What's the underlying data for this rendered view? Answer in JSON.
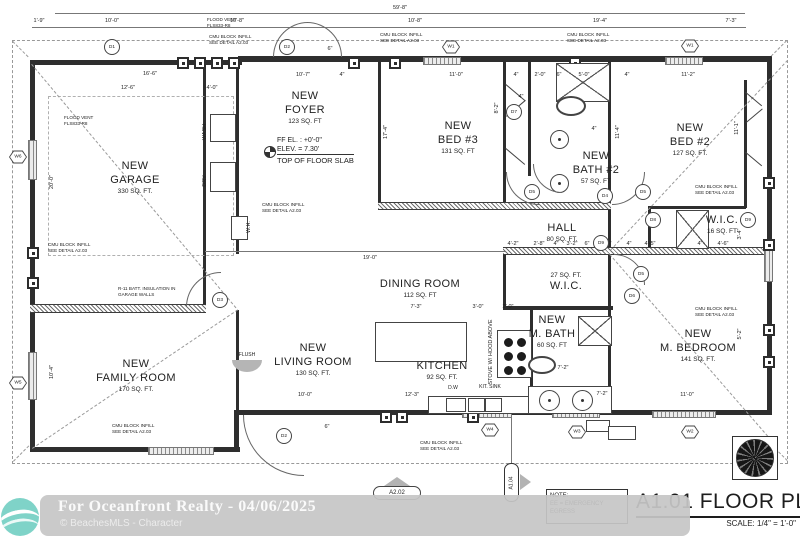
{
  "colors": {
    "wall": "#2e2e2e",
    "line": "#555555",
    "dashed": "#999999",
    "teal_logo": "#7fd3c8",
    "watermark_bg": "#c6c6c6",
    "marker_gray": "#b3b3b3"
  },
  "title_block": {
    "title": "A1.01 FLOOR PLAN",
    "scale": "SCALE: 1/4\" = 1'-0\""
  },
  "note_box": {
    "l1": "NOTE:",
    "l2": "EE = EMERGENCY",
    "l3": "EGRESS"
  },
  "watermark": {
    "line1": "For Oceanfront Realty - 04/06/2025",
    "line2": "© BeachesMLS - Character"
  },
  "markers": {
    "a202": "A2.02",
    "a104": "A1.04"
  },
  "ff_note": {
    "l1": "FF EL. : +0'-0\"",
    "l2": "ELEV. = 7.30'",
    "l3": "TOP OF FLOOR SLAB"
  },
  "rooms": [
    {
      "lines": [
        "NEW",
        "GARAGE"
      ],
      "sqft": "330 SQ. FT.",
      "x": 135,
      "y": 160
    },
    {
      "lines": [
        "NEW",
        "FOYER"
      ],
      "sqft": "123 SQ. FT",
      "x": 305,
      "y": 90
    },
    {
      "lines": [
        "NEW",
        "BED #3"
      ],
      "sqft": "131 SQ. FT",
      "x": 458,
      "y": 120
    },
    {
      "lines": [
        "NEW",
        "BATH #2"
      ],
      "sqft": "57 SQ. FT",
      "x": 596,
      "y": 150
    },
    {
      "lines": [
        "NEW",
        "BED #2"
      ],
      "sqft": "127 SQ. FT.",
      "x": 690,
      "y": 122
    },
    {
      "lines": [
        "HALL"
      ],
      "sqft": "80 SQ. FT.",
      "x": 562,
      "y": 222
    },
    {
      "lines": [
        "W.I.C."
      ],
      "sqft": "16 SQ. FT",
      "x": 722,
      "y": 214
    },
    {
      "lines": [
        "27 SQ. FT.",
        "W.I.C."
      ],
      "sqft": "",
      "x": 566,
      "y": 272
    },
    {
      "lines": [
        "DINING ROOM"
      ],
      "sqft": "112 SQ. FT",
      "x": 420,
      "y": 278
    },
    {
      "lines": [
        "NEW",
        "FAMILY ROOM"
      ],
      "sqft": "170 SQ. FT.",
      "x": 136,
      "y": 358
    },
    {
      "lines": [
        "NEW",
        "LIVING ROOM"
      ],
      "sqft": "130 SQ. FT.",
      "x": 313,
      "y": 342
    },
    {
      "lines": [
        "KITCHEN"
      ],
      "sqft": "92 SQ. FT.",
      "x": 442,
      "y": 360
    },
    {
      "lines": [
        "NEW",
        "M. BATH"
      ],
      "sqft": "60 SQ. FT",
      "x": 552,
      "y": 314
    },
    {
      "lines": [
        "NEW",
        "M. BEDROOM"
      ],
      "sqft": "141 SQ. FT.",
      "x": 698,
      "y": 328
    }
  ],
  "dims": [
    {
      "t": "59'-8\"",
      "x": 400,
      "y": 5
    },
    {
      "t": "1'-9\"",
      "x": 39,
      "y": 18
    },
    {
      "t": "10'-0\"",
      "x": 112,
      "y": 18
    },
    {
      "t": "10'-8\"",
      "x": 237,
      "y": 18
    },
    {
      "t": "10'-8\"",
      "x": 415,
      "y": 18
    },
    {
      "t": "19'-4\"",
      "x": 600,
      "y": 18
    },
    {
      "t": "7'-3\"",
      "x": 731,
      "y": 18
    },
    {
      "t": "16'-6\"",
      "x": 150,
      "y": 71
    },
    {
      "t": "12'-6\"",
      "x": 128,
      "y": 85
    },
    {
      "t": "4'-0\"",
      "x": 212,
      "y": 85
    },
    {
      "t": "10'-7\"",
      "x": 303,
      "y": 72
    },
    {
      "t": "4\"",
      "x": 342,
      "y": 72
    },
    {
      "t": "11'-0\"",
      "x": 456,
      "y": 72
    },
    {
      "t": "4\"",
      "x": 516,
      "y": 72
    },
    {
      "t": "2'-0\"",
      "x": 540,
      "y": 72
    },
    {
      "t": "6\"",
      "x": 559,
      "y": 72
    },
    {
      "t": "5'-0\"",
      "x": 584,
      "y": 72
    },
    {
      "t": "4\"",
      "x": 627,
      "y": 72
    },
    {
      "t": "11'-2\"",
      "x": 688,
      "y": 72
    },
    {
      "t": "6\"",
      "x": 330,
      "y": 46
    },
    {
      "t": "20'-0\"",
      "x": 52,
      "y": 182,
      "r": 1
    },
    {
      "t": "10'-4\"",
      "x": 52,
      "y": 372,
      "r": 1
    },
    {
      "t": "17'-4\"",
      "x": 386,
      "y": 132,
      "r": 1
    },
    {
      "t": "8'-2\"",
      "x": 497,
      "y": 108,
      "r": 1
    },
    {
      "t": "11'-4\"",
      "x": 618,
      "y": 132,
      "r": 1
    },
    {
      "t": "11'-1\"",
      "x": 737,
      "y": 128,
      "r": 1
    },
    {
      "t": "3'-4\"",
      "x": 740,
      "y": 234,
      "r": 1
    },
    {
      "t": "5'-2\"",
      "x": 740,
      "y": 334,
      "r": 1
    },
    {
      "t": "4\"",
      "x": 594,
      "y": 126
    },
    {
      "t": "4\"",
      "x": 521,
      "y": 94
    },
    {
      "t": "4'-2\"",
      "x": 513,
      "y": 241
    },
    {
      "t": "2'-8\"",
      "x": 539,
      "y": 241
    },
    {
      "t": "4\"",
      "x": 556,
      "y": 241
    },
    {
      "t": "3'-2\"",
      "x": 572,
      "y": 241
    },
    {
      "t": "6\"",
      "x": 587,
      "y": 241
    },
    {
      "t": "3'-6\"",
      "x": 606,
      "y": 241
    },
    {
      "t": "4\"",
      "x": 629,
      "y": 241
    },
    {
      "t": "4'-5\"",
      "x": 650,
      "y": 241
    },
    {
      "t": "4\"",
      "x": 700,
      "y": 241
    },
    {
      "t": "4'-6\"",
      "x": 723,
      "y": 241
    },
    {
      "t": "19'-0\"",
      "x": 370,
      "y": 255
    },
    {
      "t": "7'-3\"",
      "x": 416,
      "y": 304
    },
    {
      "t": "3'-0\"",
      "x": 478,
      "y": 304
    },
    {
      "t": "2'-0\"",
      "x": 508,
      "y": 304
    },
    {
      "t": "10'-0\"",
      "x": 305,
      "y": 392
    },
    {
      "t": "12'-3\"",
      "x": 412,
      "y": 392
    },
    {
      "t": "6\"",
      "x": 327,
      "y": 424
    },
    {
      "t": "7'-2\"",
      "x": 563,
      "y": 365
    },
    {
      "t": "7'-2\"",
      "x": 602,
      "y": 391
    },
    {
      "t": "11'-0\"",
      "x": 687,
      "y": 392
    }
  ],
  "notes": [
    {
      "l": [
        "FLOOD VENT",
        "FLS833-R8"
      ],
      "x": 207,
      "y": 17
    },
    {
      "l": [
        "CMU BLOCK INFILL",
        "SEE DETAIL A2.03"
      ],
      "x": 209,
      "y": 34
    },
    {
      "l": [
        "CMU BLOCK INFILL",
        "SEE DETAIL A2.03"
      ],
      "x": 380,
      "y": 32
    },
    {
      "l": [
        "CMU BLOCK INFILL",
        "SEE DETAIL A2.03"
      ],
      "x": 567,
      "y": 32
    },
    {
      "l": [
        "FLOOD VENT",
        "FLS833-R8"
      ],
      "x": 64,
      "y": 115
    },
    {
      "l": [
        "CMU BLOCK INFILL",
        "SEE DETAIL A2.03"
      ],
      "x": 48,
      "y": 242
    },
    {
      "l": [
        "CMU BLOCK INFILL",
        "SEE DETAIL A2.03"
      ],
      "x": 262,
      "y": 202
    },
    {
      "l": [
        "CMU BLOCK INFILL",
        "SEE DETAIL A2.03"
      ],
      "x": 695,
      "y": 184
    },
    {
      "l": [
        "CMU BLOCK INFILL",
        "SEE DETAIL A2.03"
      ],
      "x": 695,
      "y": 306
    },
    {
      "l": [
        "R-11 BATT. INSULATION IN",
        "GARAGE WALLS"
      ],
      "x": 118,
      "y": 286
    },
    {
      "l": [
        "CMU BLOCK INFILL",
        "SEE DETAIL A2.03"
      ],
      "x": 112,
      "y": 423
    },
    {
      "l": [
        "CMU BLOCK INFILL",
        "SEE DETAIL A2.03"
      ],
      "x": 420,
      "y": 440
    }
  ],
  "vtexts": [
    {
      "t": "WASH",
      "x": 205,
      "y": 132
    },
    {
      "t": "DRY",
      "x": 205,
      "y": 181
    },
    {
      "t": "W.H.",
      "x": 249,
      "y": 227
    },
    {
      "t": "STOVE W/ HOOD ABOVE",
      "x": 491,
      "y": 352
    }
  ],
  "labels": [
    {
      "t": "D.W",
      "x": 453,
      "y": 385
    },
    {
      "t": "KIT. SINK",
      "x": 490,
      "y": 384
    },
    {
      "t": "FLUSH",
      "x": 247,
      "y": 352
    }
  ],
  "tags": [
    {
      "k": "c",
      "t": "D1",
      "x": 112,
      "y": 47
    },
    {
      "k": "c",
      "t": "D2",
      "x": 287,
      "y": 47
    },
    {
      "k": "c",
      "t": "D2",
      "x": 284,
      "y": 436
    },
    {
      "k": "c",
      "t": "D3",
      "x": 220,
      "y": 300
    },
    {
      "k": "c",
      "t": "D4",
      "x": 605,
      "y": 196
    },
    {
      "k": "c",
      "t": "D5",
      "x": 532,
      "y": 192
    },
    {
      "k": "c",
      "t": "D5",
      "x": 643,
      "y": 192
    },
    {
      "k": "c",
      "t": "D5",
      "x": 641,
      "y": 274
    },
    {
      "k": "c",
      "t": "D6",
      "x": 632,
      "y": 296
    },
    {
      "k": "c",
      "t": "D7",
      "x": 514,
      "y": 112
    },
    {
      "k": "c",
      "t": "D8",
      "x": 653,
      "y": 220
    },
    {
      "k": "c",
      "t": "D9",
      "x": 601,
      "y": 243
    },
    {
      "k": "c",
      "t": "D9",
      "x": 748,
      "y": 220
    },
    {
      "k": "h",
      "t": "W1",
      "sfx": "EE",
      "x": 451,
      "y": 47
    },
    {
      "k": "h",
      "t": "W1",
      "sfx": "EE",
      "x": 690,
      "y": 46
    },
    {
      "k": "h",
      "t": "W6",
      "x": 18,
      "y": 157
    },
    {
      "k": "h",
      "t": "W5",
      "sfx": "EE",
      "sp": "b",
      "x": 18,
      "y": 383
    },
    {
      "k": "h",
      "t": "W4",
      "x": 490,
      "y": 430
    },
    {
      "k": "h",
      "t": "W3",
      "x": 577,
      "y": 432
    },
    {
      "k": "h",
      "t": "W2",
      "sfx": "EE",
      "x": 690,
      "y": 432
    }
  ],
  "geometry": {
    "walls": [
      {
        "x": 30,
        "y": 60,
        "w": 212,
        "h": 5
      },
      {
        "x": 238,
        "y": 56,
        "w": 534,
        "h": 6
      },
      {
        "x": 30,
        "y": 60,
        "w": 5,
        "h": 392
      },
      {
        "x": 30,
        "y": 447,
        "w": 210,
        "h": 5
      },
      {
        "x": 234,
        "y": 410,
        "w": 5,
        "h": 42
      },
      {
        "x": 234,
        "y": 410,
        "w": 538,
        "h": 5
      },
      {
        "x": 767,
        "y": 56,
        "w": 5,
        "h": 359
      },
      {
        "x": 203,
        "y": 65,
        "w": 3,
        "h": 243
      },
      {
        "x": 236,
        "y": 65,
        "w": 3,
        "h": 189
      },
      {
        "x": 378,
        "y": 62,
        "w": 3,
        "h": 146
      },
      {
        "x": 503,
        "y": 62,
        "w": 3,
        "h": 144
      },
      {
        "x": 528,
        "y": 62,
        "w": 3,
        "h": 114
      },
      {
        "x": 608,
        "y": 62,
        "w": 3,
        "h": 194
      },
      {
        "x": 648,
        "y": 206,
        "w": 3,
        "h": 45
      },
      {
        "x": 648,
        "y": 206,
        "w": 98,
        "h": 3
      },
      {
        "x": 744,
        "y": 80,
        "w": 3,
        "h": 128
      },
      {
        "x": 503,
        "y": 252,
        "w": 3,
        "h": 58
      },
      {
        "x": 503,
        "y": 306,
        "w": 110,
        "h": 4
      },
      {
        "x": 530,
        "y": 310,
        "w": 3,
        "h": 103
      },
      {
        "x": 608,
        "y": 252,
        "w": 3,
        "h": 162
      },
      {
        "x": 236,
        "y": 310,
        "w": 3,
        "h": 102
      },
      {
        "x": 30,
        "y": 304,
        "w": 176,
        "h": 7,
        "s": "hatch"
      },
      {
        "x": 378,
        "y": 202,
        "w": 233,
        "h": 6,
        "s": "hatch"
      },
      {
        "x": 503,
        "y": 247,
        "w": 269,
        "h": 6,
        "s": "hatch"
      }
    ],
    "windows": [
      {
        "x": 423,
        "y": 57,
        "w": 36,
        "h": 6
      },
      {
        "x": 665,
        "y": 57,
        "w": 36,
        "h": 6
      },
      {
        "x": 28,
        "y": 140,
        "w": 7,
        "h": 38
      },
      {
        "x": 28,
        "y": 352,
        "w": 7,
        "h": 46
      },
      {
        "x": 148,
        "y": 447,
        "w": 64,
        "h": 6
      },
      {
        "x": 462,
        "y": 411,
        "w": 48,
        "h": 5
      },
      {
        "x": 552,
        "y": 411,
        "w": 46,
        "h": 5
      },
      {
        "x": 652,
        "y": 411,
        "w": 62,
        "h": 5
      },
      {
        "x": 764,
        "y": 250,
        "w": 7,
        "h": 30
      }
    ],
    "vents": [
      {
        "x": 177,
        "y": 57
      },
      {
        "x": 194,
        "y": 57
      },
      {
        "x": 211,
        "y": 57
      },
      {
        "x": 228,
        "y": 57
      },
      {
        "x": 348,
        "y": 57
      },
      {
        "x": 389,
        "y": 57
      },
      {
        "x": 569,
        "y": 57
      },
      {
        "x": 380,
        "y": 411
      },
      {
        "x": 396,
        "y": 411
      },
      {
        "x": 467,
        "y": 411
      },
      {
        "x": 27,
        "y": 247
      },
      {
        "x": 27,
        "y": 277
      },
      {
        "x": 763,
        "y": 177
      },
      {
        "x": 763,
        "y": 239
      },
      {
        "x": 763,
        "y": 324
      },
      {
        "x": 763,
        "y": 356
      }
    ],
    "lines": [
      {
        "x": 205,
        "y": 251,
        "w": 300,
        "h": 1
      },
      {
        "x": 511,
        "y": 415,
        "w": 1,
        "h": 50
      },
      {
        "x": 55,
        "y": 13,
        "w": 690,
        "h": 1
      },
      {
        "x": 32,
        "y": 27,
        "w": 714,
        "h": 1
      }
    ],
    "dashrects": [
      {
        "x": 48,
        "y": 96,
        "w": 184,
        "h": 158
      }
    ],
    "diagonals": [
      {
        "x": 32,
        "y": 64,
        "l": 318,
        "r": 50,
        "d": 1
      },
      {
        "x": 32,
        "y": 448,
        "l": 248,
        "r": -34,
        "d": 1
      },
      {
        "x": 610,
        "y": 250,
        "l": 260,
        "r": -47,
        "d": 1
      },
      {
        "x": 610,
        "y": 254,
        "l": 246,
        "r": 49,
        "d": 1
      },
      {
        "x": 13,
        "y": 41,
        "l": 22,
        "r": 45,
        "d": 1
      },
      {
        "x": 787,
        "y": 41,
        "l": 22,
        "r": 135,
        "d": 1
      },
      {
        "x": 13,
        "y": 461,
        "l": 22,
        "r": -45,
        "d": 1
      },
      {
        "x": 787,
        "y": 461,
        "l": 22,
        "r": -135,
        "d": 1
      },
      {
        "x": 506,
        "y": 84,
        "l": 25,
        "r": 40,
        "d": 0
      },
      {
        "x": 506,
        "y": 116,
        "l": 25,
        "r": -40,
        "d": 0
      },
      {
        "x": 506,
        "y": 148,
        "l": 25,
        "r": 40,
        "d": 0
      },
      {
        "x": 746,
        "y": 92,
        "l": 21,
        "r": 40,
        "d": 0
      },
      {
        "x": 746,
        "y": 122,
        "l": 21,
        "r": -40,
        "d": 0
      },
      {
        "x": 746,
        "y": 152,
        "l": 21,
        "r": 40,
        "d": 0
      }
    ],
    "boxes": [
      {
        "x": 375,
        "y": 322,
        "w": 90,
        "h": 38,
        "s": "o"
      },
      {
        "x": 428,
        "y": 396,
        "w": 100,
        "h": 16,
        "s": "o"
      },
      {
        "x": 446,
        "y": 398,
        "w": 18,
        "h": 12,
        "s": "o"
      },
      {
        "x": 468,
        "y": 398,
        "w": 15,
        "h": 12,
        "s": "o"
      },
      {
        "x": 485,
        "y": 398,
        "w": 15,
        "h": 12,
        "s": "o"
      },
      {
        "x": 497,
        "y": 330,
        "w": 33,
        "h": 46,
        "s": "o"
      },
      {
        "x": 210,
        "y": 114,
        "w": 24,
        "h": 26,
        "s": "o"
      },
      {
        "x": 210,
        "y": 162,
        "w": 24,
        "h": 28,
        "s": "o"
      },
      {
        "x": 231,
        "y": 216,
        "w": 15,
        "h": 22,
        "s": "o"
      },
      {
        "x": 528,
        "y": 386,
        "w": 82,
        "h": 26,
        "s": "o"
      },
      {
        "x": 586,
        "y": 420,
        "w": 22,
        "h": 10,
        "s": "o"
      },
      {
        "x": 608,
        "y": 426,
        "w": 26,
        "h": 12,
        "s": "o"
      },
      {
        "x": 556,
        "y": 63,
        "w": 52,
        "h": 37,
        "s": "x"
      },
      {
        "x": 676,
        "y": 210,
        "w": 31,
        "h": 37,
        "s": "x"
      },
      {
        "x": 578,
        "y": 316,
        "w": 32,
        "h": 28,
        "s": "x"
      },
      {
        "x": 232,
        "y": 360,
        "w": 30,
        "h": 12,
        "s": "g"
      }
    ],
    "circles": [
      {
        "x": 550,
        "y": 130,
        "d": 17,
        "s": "o"
      },
      {
        "x": 550,
        "y": 174,
        "d": 17,
        "s": "o"
      },
      {
        "x": 539,
        "y": 390,
        "d": 19,
        "s": "o"
      },
      {
        "x": 572,
        "y": 390,
        "d": 19,
        "s": "o"
      },
      {
        "x": 504,
        "y": 338,
        "d": 7,
        "s": "f"
      },
      {
        "x": 517,
        "y": 338,
        "d": 7,
        "s": "f"
      },
      {
        "x": 504,
        "y": 352,
        "d": 7,
        "s": "f"
      },
      {
        "x": 517,
        "y": 352,
        "d": 7,
        "s": "f"
      },
      {
        "x": 504,
        "y": 366,
        "d": 7,
        "s": "f"
      },
      {
        "x": 517,
        "y": 366,
        "d": 7,
        "s": "f"
      }
    ],
    "ellipses": [
      {
        "x": 556,
        "y": 96,
        "w": 26,
        "h": 16
      },
      {
        "x": 528,
        "y": 356,
        "w": 24,
        "h": 14
      }
    ],
    "arcs": [
      {
        "x": 273,
        "y": 22,
        "s": 34,
        "c": "tl"
      },
      {
        "x": 307,
        "y": 22,
        "s": 34,
        "c": "tr"
      },
      {
        "x": 243,
        "y": 415,
        "s": 60,
        "c": "bl"
      },
      {
        "x": 186,
        "y": 272,
        "s": 34,
        "c": "tl"
      },
      {
        "x": 506,
        "y": 172,
        "s": 32,
        "c": "bl"
      },
      {
        "x": 612,
        "y": 172,
        "s": 32,
        "c": "br"
      },
      {
        "x": 614,
        "y": 254,
        "s": 30,
        "c": "tr"
      },
      {
        "x": 533,
        "y": 164,
        "s": 28,
        "c": "bl"
      }
    ]
  }
}
